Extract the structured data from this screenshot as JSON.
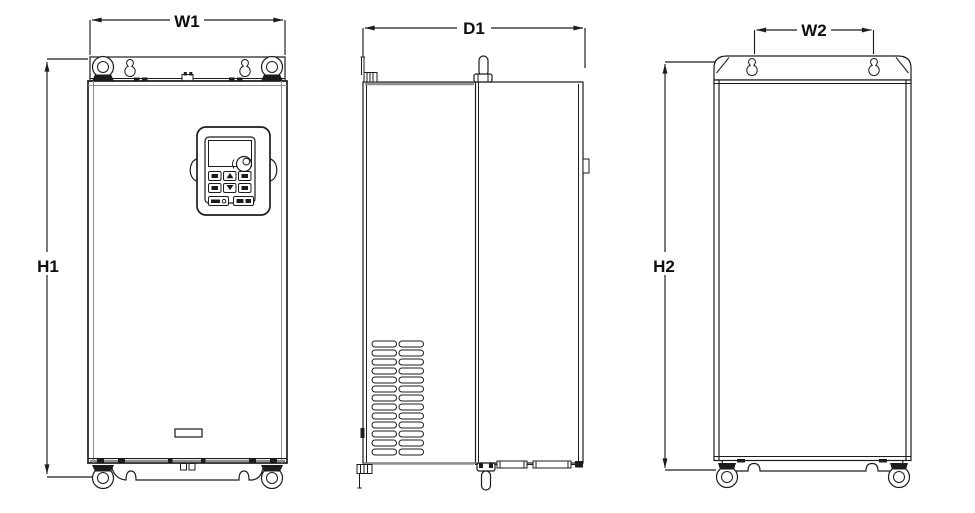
{
  "drawing_labels": {
    "w1": {
      "label": "W1"
    },
    "h1": {
      "label": "H1"
    },
    "d1": {
      "label": "D1"
    },
    "w2": {
      "label": "W2"
    },
    "h2": {
      "label": "H2"
    }
  },
  "colors": {
    "line": "#1c1c1c",
    "line_soft": "#8f8f8f",
    "background": "#ffffff"
  }
}
